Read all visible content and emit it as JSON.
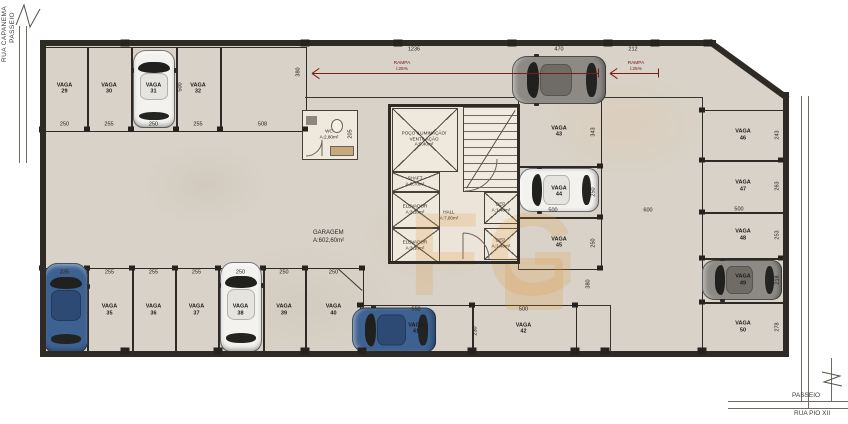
{
  "title": {
    "line1": "GARAGEM",
    "line2": "A:602,60m²"
  },
  "streets": {
    "left_outer": "RUA CAPANEMA",
    "left_inner": "PASSEIO",
    "bottom_upper": "PASSEIO",
    "bottom_lower": "RUA PIO XII"
  },
  "colors": {
    "floor": "#d8d2c8",
    "wall": "#2e2a25",
    "ramp_arrow": "#7e1b15",
    "watermark": "#e29836",
    "room_fill": "#efe8dd"
  },
  "ramp": {
    "label_top": "RAMPA",
    "label_bottom": "i:25%",
    "arrows": [
      {
        "x1": 312,
        "x2": 598,
        "y": 73,
        "lx": 402
      },
      {
        "x1": 610,
        "x2": 658,
        "y": 73,
        "lx": 636
      }
    ],
    "dims": [
      {
        "text": "1236",
        "x": 414,
        "y": 50
      },
      {
        "text": "470",
        "x": 559,
        "y": 50
      },
      {
        "text": "212",
        "x": 633,
        "y": 50
      }
    ]
  },
  "vagas": [
    {
      "label": "VAGA",
      "num": "29",
      "x": 42,
      "y": 47,
      "w": 45,
      "h": 83,
      "dim": "250",
      "ds": "b"
    },
    {
      "label": "VAGA",
      "num": "30",
      "x": 87,
      "y": 47,
      "w": 44,
      "h": 83,
      "dim": "255",
      "ds": "b"
    },
    {
      "label": "VAGA",
      "num": "31",
      "x": 131,
      "y": 47,
      "w": 45,
      "h": 83,
      "dim": "250",
      "ds": "b"
    },
    {
      "label": "VAGA",
      "num": "32",
      "x": 176,
      "y": 47,
      "w": 44,
      "h": 83,
      "dim": "255",
      "ds": "b"
    },
    {
      "label": null,
      "num": null,
      "x": 220,
      "y": 47,
      "w": 85,
      "h": 83,
      "dim": "508",
      "ds": "b"
    },
    {
      "label": null,
      "num": null,
      "x": 42,
      "y": 268,
      "w": 45,
      "h": 84,
      "dim": "235",
      "ds": "t"
    },
    {
      "label": "VAGA",
      "num": "35",
      "x": 87,
      "y": 268,
      "w": 45,
      "h": 84,
      "dim": "255",
      "ds": "t"
    },
    {
      "label": "VAGA",
      "num": "36",
      "x": 132,
      "y": 268,
      "w": 43,
      "h": 84,
      "dim": "255",
      "ds": "t"
    },
    {
      "label": "VAGA",
      "num": "37",
      "x": 175,
      "y": 268,
      "w": 43,
      "h": 84,
      "dim": "255",
      "ds": "t"
    },
    {
      "label": "VAGA",
      "num": "38",
      "x": 218,
      "y": 268,
      "w": 45,
      "h": 84,
      "dim": "250",
      "ds": "t"
    },
    {
      "label": "VAGA",
      "num": "39",
      "x": 263,
      "y": 268,
      "w": 42,
      "h": 84,
      "dim": "250",
      "ds": "t"
    },
    {
      "label": "VAGA",
      "num": "40",
      "x": 305,
      "y": 268,
      "w": 57,
      "h": 84,
      "dim": "250",
      "ds": "t"
    },
    {
      "label": "VAGA",
      "num": "41",
      "x": 360,
      "y": 305,
      "w": 112,
      "h": 47,
      "dim": "550",
      "ds": "t"
    },
    {
      "label": "VAGA",
      "num": "42",
      "x": 472,
      "y": 305,
      "w": 103,
      "h": 47,
      "dim": "500",
      "ds": "t"
    },
    {
      "label": "VAGA",
      "num": "43",
      "x": 518,
      "y": 97,
      "w": 82,
      "h": 69,
      "dim": "343",
      "ds": "r"
    },
    {
      "label": "VAGA",
      "num": "44",
      "x": 518,
      "y": 166,
      "w": 82,
      "h": 51,
      "dim": "250",
      "ds": "r"
    },
    {
      "label": "VAGA",
      "num": "45",
      "x": 518,
      "y": 217,
      "w": 82,
      "h": 51,
      "dim": "250",
      "ds": "r"
    },
    {
      "label": "VAGA",
      "num": "46",
      "x": 702,
      "y": 110,
      "w": 82,
      "h": 50,
      "dim": "243",
      "ds": "r"
    },
    {
      "label": "VAGA",
      "num": "47",
      "x": 702,
      "y": 160,
      "w": 82,
      "h": 52,
      "dim": "263",
      "ds": "r"
    },
    {
      "label": "VAGA",
      "num": "48",
      "x": 702,
      "y": 212,
      "w": 82,
      "h": 46,
      "dim": "253",
      "ds": "r"
    },
    {
      "label": "VAGA",
      "num": "49",
      "x": 702,
      "y": 258,
      "w": 82,
      "h": 44,
      "dim": "218",
      "ds": "r"
    },
    {
      "label": "VAGA",
      "num": "50",
      "x": 702,
      "y": 302,
      "w": 82,
      "h": 50,
      "dim": "278",
      "ds": "r"
    }
  ],
  "dims": [
    {
      "text": "380",
      "x": 299,
      "y": 72,
      "v": 1
    },
    {
      "text": "500",
      "x": 181,
      "y": 87,
      "v": 1
    },
    {
      "text": "500",
      "x": 553,
      "y": 211
    },
    {
      "text": "600",
      "x": 648,
      "y": 211
    },
    {
      "text": "500",
      "x": 739,
      "y": 210
    },
    {
      "text": "380",
      "x": 589,
      "y": 284,
      "v": 1
    },
    {
      "text": "230",
      "x": 476,
      "y": 331,
      "v": 1
    },
    {
      "text": "205",
      "x": 351,
      "y": 134,
      "v": 1
    }
  ],
  "cars": [
    {
      "x": 133,
      "y": 50,
      "w": 42,
      "h": 78,
      "o": "v",
      "color": "white"
    },
    {
      "x": 512,
      "y": 56,
      "w": 94,
      "h": 48,
      "o": "h",
      "color": "gray"
    },
    {
      "x": 44,
      "y": 263,
      "w": 44,
      "h": 90,
      "o": "v",
      "color": "blue"
    },
    {
      "x": 220,
      "y": 262,
      "w": 42,
      "h": 90,
      "o": "v",
      "color": "white"
    },
    {
      "x": 352,
      "y": 307,
      "w": 84,
      "h": 45,
      "o": "h",
      "color": "blue"
    },
    {
      "x": 519,
      "y": 168,
      "w": 80,
      "h": 44,
      "o": "h",
      "color": "white"
    },
    {
      "x": 702,
      "y": 260,
      "w": 80,
      "h": 40,
      "o": "h",
      "color": "gray"
    }
  ],
  "core": {
    "rooms": [
      {
        "name": "poco-iluminacao",
        "lines": [
          "POÇO ILUMINAÇÃO/",
          "VENTILAÇÃO",
          "A:5,40m²"
        ],
        "x": 392,
        "y": 108,
        "w": 64,
        "h": 62,
        "cross": true
      },
      {
        "name": "shaft",
        "lines": [
          "SHAFT",
          "A:0,70m²"
        ],
        "x": 392,
        "y": 172,
        "w": 46,
        "h": 18,
        "cross": true
      },
      {
        "name": "elevador-1",
        "lines": [
          "ELEVADOR",
          "A:3,10m²"
        ],
        "x": 392,
        "y": 192,
        "w": 46,
        "h": 34,
        "cross": true
      },
      {
        "name": "elevador-2",
        "lines": [
          "ELEVADOR",
          "A:3,10m²"
        ],
        "x": 392,
        "y": 228,
        "w": 46,
        "h": 34,
        "cross": true
      },
      {
        "name": "dep-1",
        "lines": [
          "DEP.",
          "A:1,40m²"
        ],
        "x": 484,
        "y": 192,
        "w": 34,
        "h": 30,
        "cross": true
      },
      {
        "name": "dep-2",
        "lines": [
          "DEP.",
          "A:1,40m²"
        ],
        "x": 484,
        "y": 228,
        "w": 34,
        "h": 30,
        "cross": true
      },
      {
        "name": "wc",
        "lines": [
          "WC",
          "A:2,80m²"
        ],
        "x": 302,
        "y": 110,
        "w": 54,
        "h": 48,
        "cross": false
      }
    ],
    "hall": {
      "line1": "HALL",
      "line2": "A:7,80m²"
    }
  },
  "watermark_text": "FG"
}
